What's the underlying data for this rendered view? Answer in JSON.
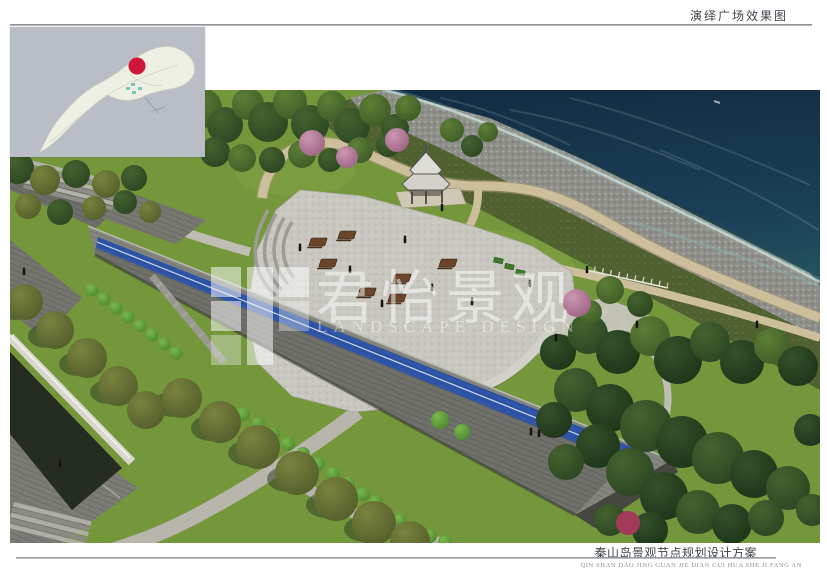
{
  "header": {
    "title": "演绎广场效果图"
  },
  "footer": {
    "title": "秦山岛景观节点规划设计方案",
    "subtitle": "QIN SHAN DAO JING GUAN JIE DIAN GUI HUA SHE JI FANG AN"
  },
  "watermark": {
    "brand_cn": "君怡景观",
    "brand_en": "LANDSCAPE DESIGN"
  },
  "inset_map": {
    "marker_color": "#cf1538",
    "island_color": "#eef0e3",
    "water_color": "#b9bdc6"
  },
  "scene": {
    "colors": {
      "ocean_deep": "#12304a",
      "ocean_shallow": "#2e6a6d",
      "lawn": "#74973c",
      "plaza": "#c9c8c0",
      "solar_blue": "#2e55a8",
      "roof_gray": "#85867f",
      "path_tan": "#cdbf9c"
    }
  }
}
